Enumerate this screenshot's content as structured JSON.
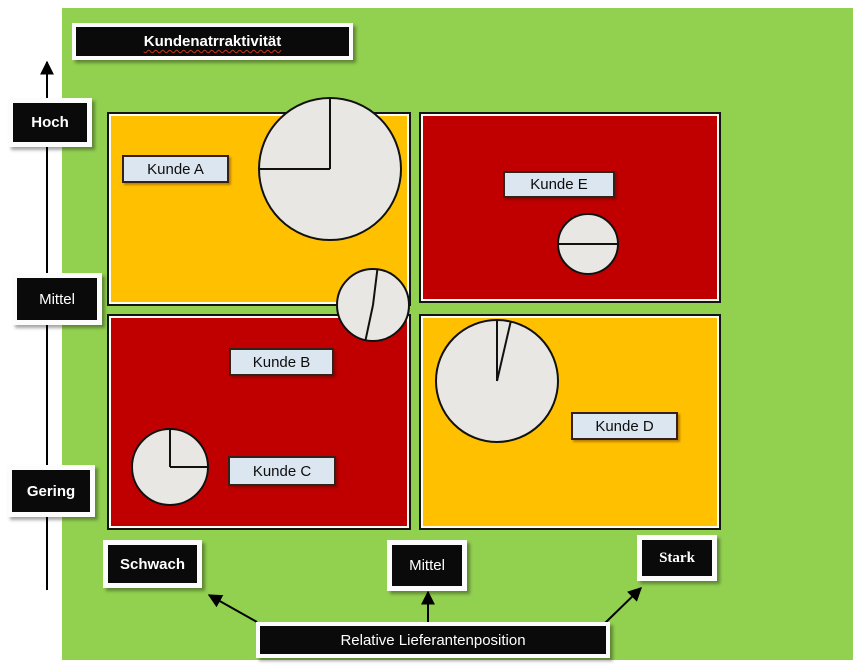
{
  "title": {
    "text": "Kundenatrraktivität"
  },
  "y_axis": {
    "ticks": [
      "Hoch",
      "Mittel",
      "Gering"
    ]
  },
  "x_axis": {
    "label": "Relative Lieferantenposition",
    "ticks": [
      "Schwach",
      "Mittel",
      "Stark"
    ]
  },
  "customers": {
    "a": "Kunde A",
    "b": "Kunde B",
    "c": "Kunde C",
    "d": "Kunde D",
    "e": "Kunde E"
  },
  "quadrants": {
    "top_left": {
      "color": "#FFC000",
      "contains": [
        "Kunde A"
      ]
    },
    "top_right": {
      "color": "#C00000",
      "contains": [
        "Kunde E"
      ]
    },
    "bottom_left": {
      "color": "#C00000",
      "contains": [
        "Kunde B",
        "Kunde C"
      ]
    },
    "bottom_right": {
      "color": "#FFC000",
      "contains": [
        "Kunde D"
      ]
    }
  },
  "colors": {
    "background_green": "#92D050",
    "yellow": "#FFC000",
    "red": "#C00000",
    "pie_fill": "#E8E7E3",
    "label_fill": "#DCE6F1",
    "box_black": "#0a0a0a"
  },
  "pies": [
    {
      "id": "pie-kunde-a",
      "cx": 330,
      "cy": 169,
      "r": 71,
      "line_angles_deg": [
        0,
        270
      ]
    },
    {
      "id": "pie-kunde-b",
      "cx": 373,
      "cy": 305,
      "r": 36,
      "line_angles_deg": [
        7,
        192
      ]
    },
    {
      "id": "pie-kunde-c",
      "cx": 170,
      "cy": 467,
      "r": 38,
      "line_angles_deg": [
        0,
        90
      ]
    },
    {
      "id": "pie-kunde-d",
      "cx": 497,
      "cy": 381,
      "r": 61,
      "line_angles_deg": [
        0,
        13
      ]
    },
    {
      "id": "pie-kunde-e",
      "cx": 588,
      "cy": 244,
      "r": 30,
      "line_angles_deg": [
        90,
        270
      ]
    }
  ]
}
